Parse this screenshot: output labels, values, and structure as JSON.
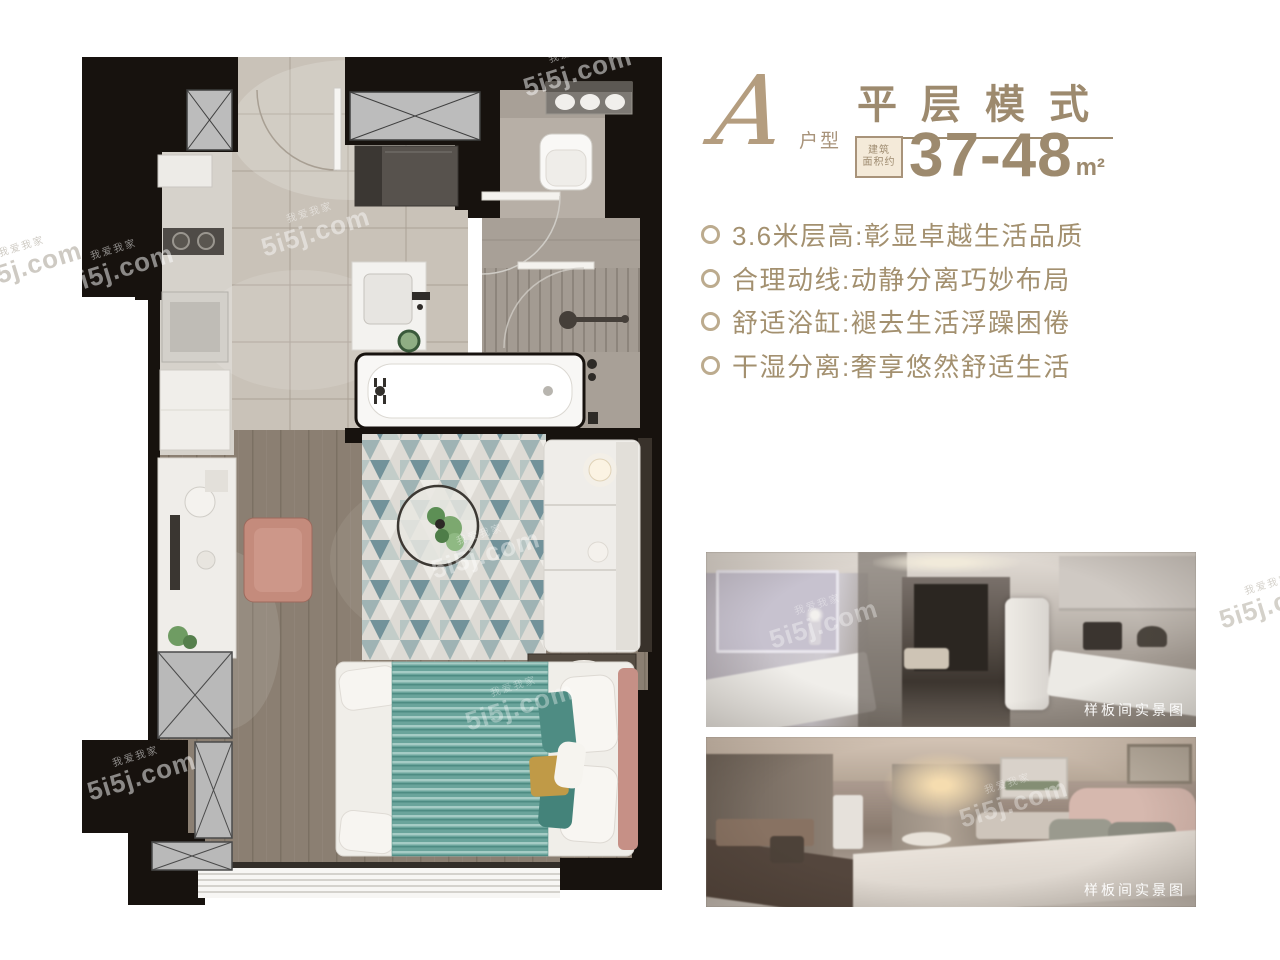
{
  "header": {
    "type_letter": "A",
    "type_label": "户型",
    "title": "平层模式",
    "area_badge_line1": "建筑",
    "area_badge_line2": "面积约",
    "area_value": "37-48",
    "area_unit": "m²"
  },
  "features": [
    "3.6米层高:彰显卓越生活品质",
    "合理动线:动静分离巧妙布局",
    "舒适浴缸:褪去生活浮躁困倦",
    "干湿分离:奢享悠然舒适生活"
  ],
  "photos": [
    {
      "caption": "样板间实景图"
    },
    {
      "caption": "样板间实景图"
    }
  ],
  "watermark": {
    "brand": "5i5j.com",
    "company": "我爱我家"
  },
  "colors": {
    "gold_text": "#9d8a6e",
    "gold_light": "#b49d7f",
    "wall_black": "#17120e",
    "tile_beige": "#c9c2b8",
    "wood_floor": "#8b7f72",
    "bed_teal": "#6aa49b",
    "chair_salmon": "#c48b7c"
  }
}
